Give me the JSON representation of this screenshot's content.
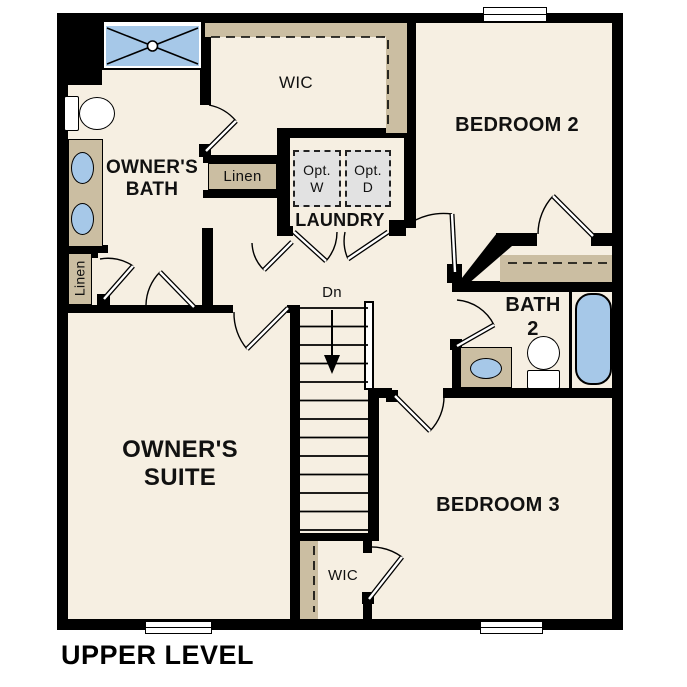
{
  "plan_title": "UPPER LEVEL",
  "rooms": {
    "owners_bath": {
      "label": "OWNER'S\nBATH"
    },
    "owners_suite": {
      "label": "OWNER'S\nSUITE"
    },
    "wic_owners": {
      "label": "WIC"
    },
    "laundry": {
      "label": "LAUNDRY"
    },
    "bedroom2": {
      "label": "BEDROOM 2"
    },
    "bath2": {
      "label": "BATH\n2"
    },
    "bedroom3": {
      "label": "BEDROOM 3"
    },
    "wic_bedroom3": {
      "label": "WIC"
    },
    "linen_hall": {
      "label": "Linen"
    },
    "linen_bath": {
      "label": "Linen"
    }
  },
  "appliances": {
    "optional_washer": {
      "label": "Opt.\nW"
    },
    "optional_dryer": {
      "label": "Opt.\nD"
    }
  },
  "stairs": {
    "direction_label": "Dn"
  },
  "fixtures": [
    "shower",
    "toilet",
    "double-vanity-sinks",
    "linen-closet",
    "bathtub",
    "vanity-sink",
    "toilet-bath2",
    "stair-railing",
    "windows",
    "closet-shelving"
  ],
  "colors": {
    "floor": "#F6EFE2",
    "wall": "#000000",
    "shelf_tan": "#CBBEA2",
    "fixture_blue": "#A6C8E8",
    "optional_gray": "#E2E2E2",
    "background": "#FFFFFF"
  }
}
